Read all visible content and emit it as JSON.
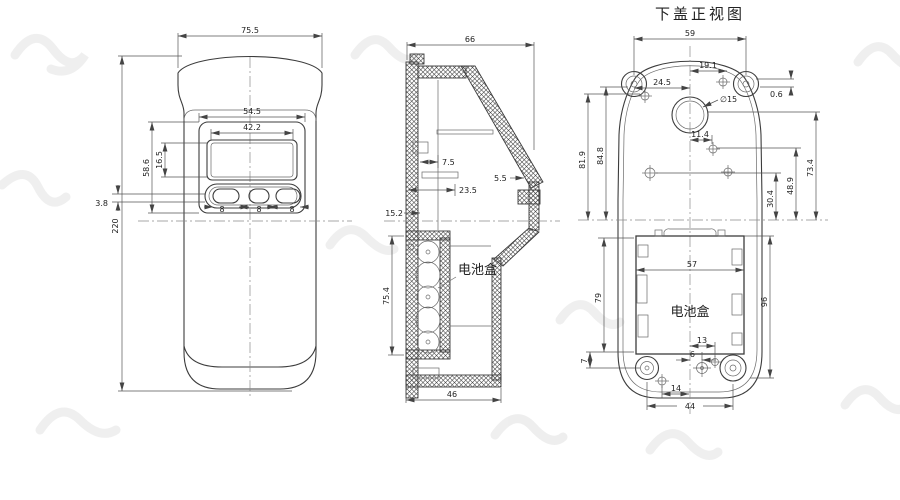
{
  "drawing": {
    "title": "下盖正视图",
    "front": {
      "w755": "75.5",
      "h220": "220",
      "w545": "54.5",
      "w422": "42.2",
      "h586": "58.6",
      "h165": "16.5",
      "o38": "3.8",
      "b1": "8",
      "b2": "8",
      "b3": "8"
    },
    "section": {
      "w66": "66",
      "r75": "7.5",
      "s235": "23.5",
      "w152": "15.2",
      "b55": "5.5",
      "h754": "75.4",
      "w46": "46",
      "battery": "电池盒"
    },
    "back": {
      "w59": "59",
      "p191": "19.1",
      "p245": "24.5",
      "hole15": "∅15",
      "o114": "11.4",
      "g06": "0.6",
      "h819": "81.9",
      "h848": "84.8",
      "h734": "73.4",
      "h489": "48.9",
      "h304": "30.4",
      "w57": "57",
      "h79": "79",
      "h96": "96",
      "f7": "7",
      "d13": "13",
      "d6": "6",
      "d14": "14",
      "d44": "44",
      "battery": "电池盒"
    }
  }
}
